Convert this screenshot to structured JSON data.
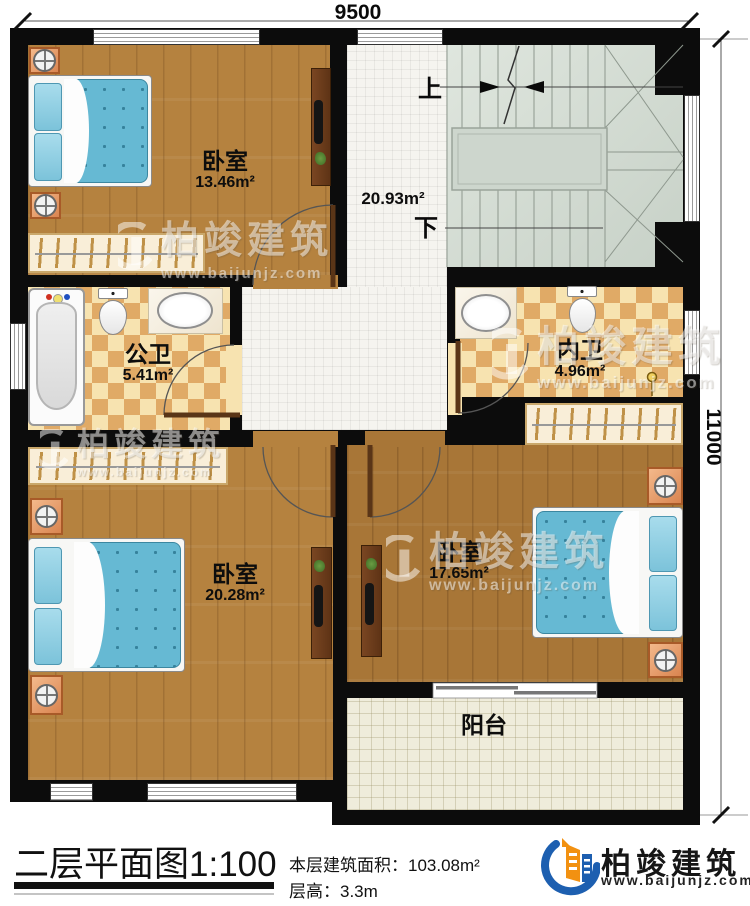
{
  "dimensions": {
    "top": "9500",
    "right": "11000"
  },
  "stairs": {
    "up_label": "上",
    "down_label": "下"
  },
  "rooms": {
    "bedroom_top_left": {
      "name": "卧室",
      "area": "13.46m²"
    },
    "hallway": {
      "area": "20.93m²"
    },
    "public_bath": {
      "name": "公卫",
      "area": "5.41m²"
    },
    "private_bath": {
      "name": "内卫",
      "area": "4.96m²"
    },
    "bedroom_bottom_left": {
      "name": "卧室",
      "area": "20.28m²"
    },
    "bedroom_bottom_right": {
      "name": "卧室",
      "area": "17.65m²"
    },
    "balcony": {
      "name": "阳台"
    }
  },
  "title_block": {
    "title": "二层平面图",
    "scale": "1:100",
    "floor_area": "本层建筑面积：103.08m²",
    "floor_height": "层高：3.3m"
  },
  "brand": {
    "name": "柏竣建筑",
    "website": "www.baijunjz.com"
  },
  "watermark": {
    "name": "柏竣建筑",
    "website": "www.baijunjz.com"
  },
  "colors": {
    "wall": "#0c0c0c",
    "wood_floor": "#b5823f",
    "wood_floor_dark": "#a87637",
    "tile_floor": "#f5f4ef",
    "checker_light": "#f7e3b0",
    "checker_dark": "#e0aa66",
    "stair_floor": "#d3dbd2",
    "balcony_floor": "#efecdb",
    "bed_blue": "#66b9d3",
    "nightstand_orange": "#e49a63",
    "logo_blue": "#1d5fb0",
    "logo_orange": "#f29111"
  }
}
